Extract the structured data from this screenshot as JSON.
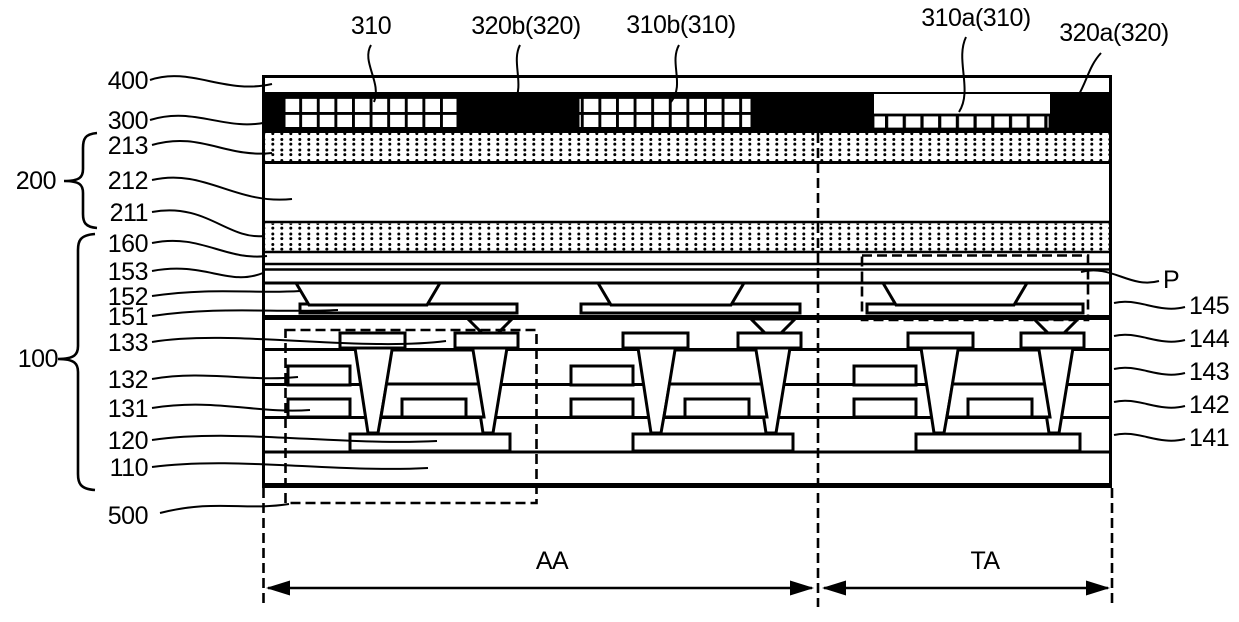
{
  "figure": {
    "type": "patent cross-section diagram of a display panel",
    "colors": {
      "line": "#000000",
      "background": "#ffffff"
    },
    "labels": {
      "left": [
        {
          "text": "400"
        },
        {
          "text": "300"
        },
        {
          "text": "213"
        },
        {
          "text": "212"
        },
        {
          "text": "211"
        },
        {
          "text": "160"
        },
        {
          "text": "153"
        },
        {
          "text": "152"
        },
        {
          "text": "151"
        },
        {
          "text": "133"
        },
        {
          "text": "132"
        },
        {
          "text": "131"
        },
        {
          "text": "120"
        },
        {
          "text": "110"
        },
        {
          "text": "500"
        }
      ],
      "groups": [
        {
          "text": "200"
        },
        {
          "text": "100"
        }
      ],
      "top": [
        {
          "text": "310"
        },
        {
          "text": "320b(320)"
        },
        {
          "text": "310b(310)"
        },
        {
          "text": "310a(310)"
        },
        {
          "text": "320a(320)"
        }
      ],
      "right": [
        {
          "text": "P"
        },
        {
          "text": "145"
        },
        {
          "text": "144"
        },
        {
          "text": "143"
        },
        {
          "text": "142"
        },
        {
          "text": "141"
        }
      ],
      "bottom": [
        {
          "text": "AA"
        },
        {
          "text": "TA"
        }
      ]
    }
  }
}
